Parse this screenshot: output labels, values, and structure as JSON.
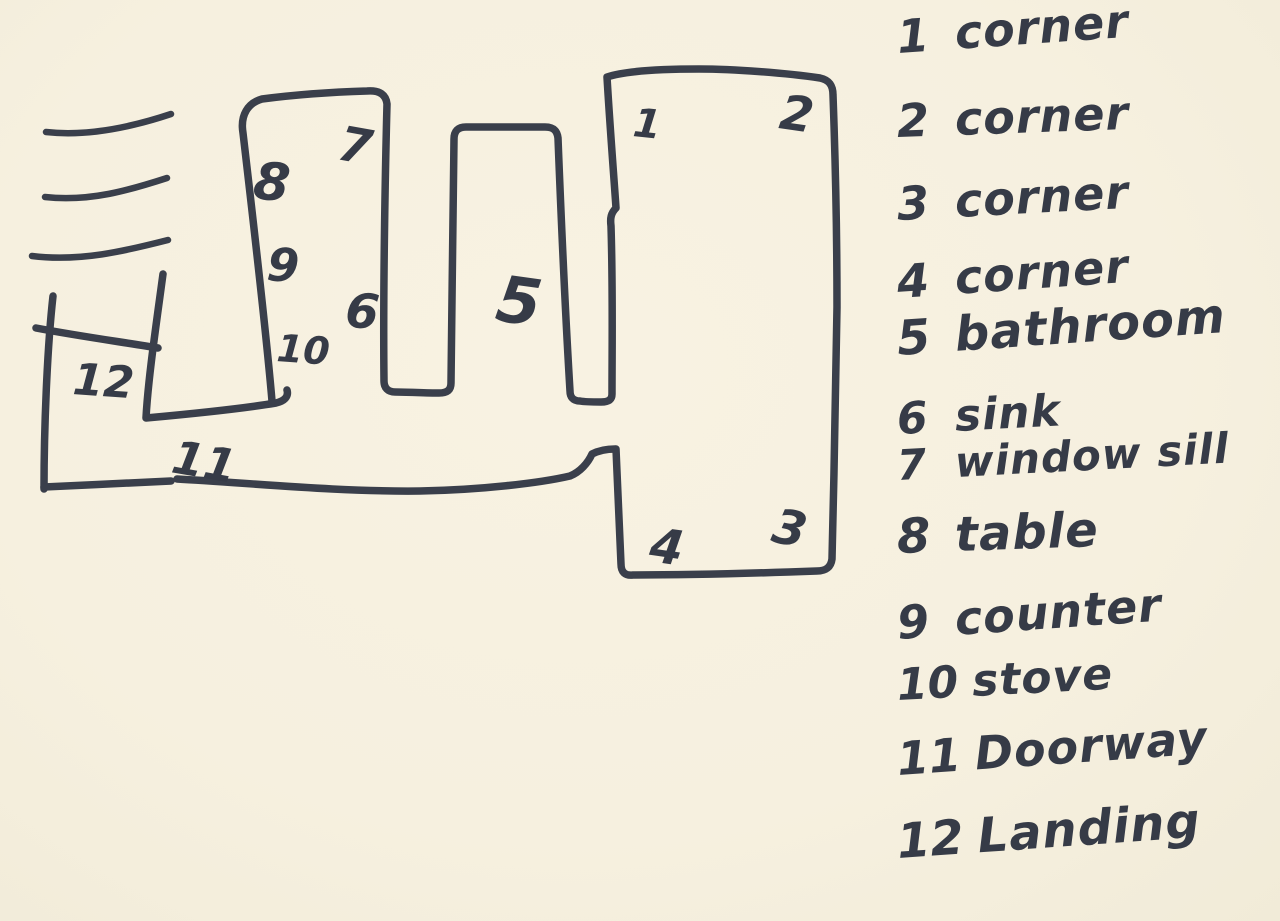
{
  "page": {
    "title": "Hand-drawn floor plan sketch with numbered measurement spots",
    "paper_color": "#f6f0df",
    "ink_color": "#3a3f4b"
  },
  "plan": {
    "description": "Sketched apartment floor plan: landing at left, doorway hallway along bottom, kitchen counter prong (window sill, table, counter, stove), bathroom prong, and large main room with four corners",
    "labels": [
      {
        "n": "1"
      },
      {
        "n": "2"
      },
      {
        "n": "3"
      },
      {
        "n": "4"
      },
      {
        "n": "5"
      },
      {
        "n": "6"
      },
      {
        "n": "7"
      },
      {
        "n": "8"
      },
      {
        "n": "9"
      },
      {
        "n": "10"
      },
      {
        "n": "11"
      },
      {
        "n": "12"
      }
    ]
  },
  "legend": {
    "items": [
      {
        "number": "1",
        "label": "corner"
      },
      {
        "number": "2",
        "label": "corner"
      },
      {
        "number": "3",
        "label": "corner"
      },
      {
        "number": "4",
        "label": "corner"
      },
      {
        "number": "5",
        "label": "bathroom"
      },
      {
        "number": "6",
        "label": "sink"
      },
      {
        "number": "7",
        "label": "window sill"
      },
      {
        "number": "8",
        "label": "table"
      },
      {
        "number": "9",
        "label": "counter"
      },
      {
        "number": "10",
        "label": "stove"
      },
      {
        "number": "11",
        "label": "Doorway"
      },
      {
        "number": "12",
        "label": "Landing"
      }
    ]
  }
}
